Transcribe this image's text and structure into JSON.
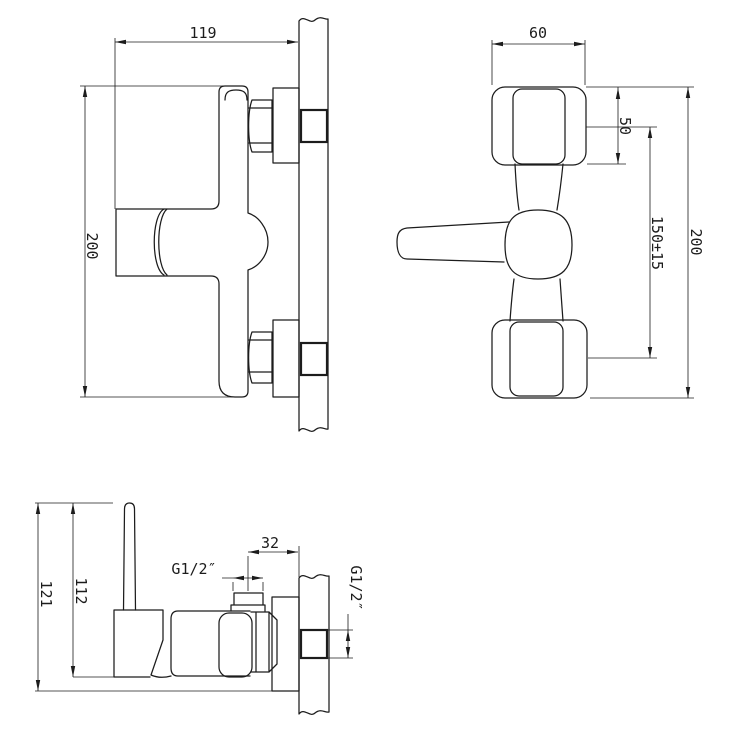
{
  "document": {
    "type": "technical-drawing shower mixer installation dimensions",
    "background": "#ffffff",
    "line_color": "#1c1c1c"
  },
  "views": {
    "side_view": {
      "width_mm": "119",
      "height_mm": "200"
    },
    "front_view": {
      "escutcheon_width_mm": "60",
      "upper_span_mm": "50",
      "connection_spacing_mm": "150±15",
      "overall_height_mm": "200"
    },
    "bottom_view": {
      "overall_depth_mm": "121",
      "body_depth_mm": "112",
      "outlet_offset_mm": "32",
      "outlet_thread": "G1/2″",
      "inlet_thread": "G1/2″"
    }
  }
}
